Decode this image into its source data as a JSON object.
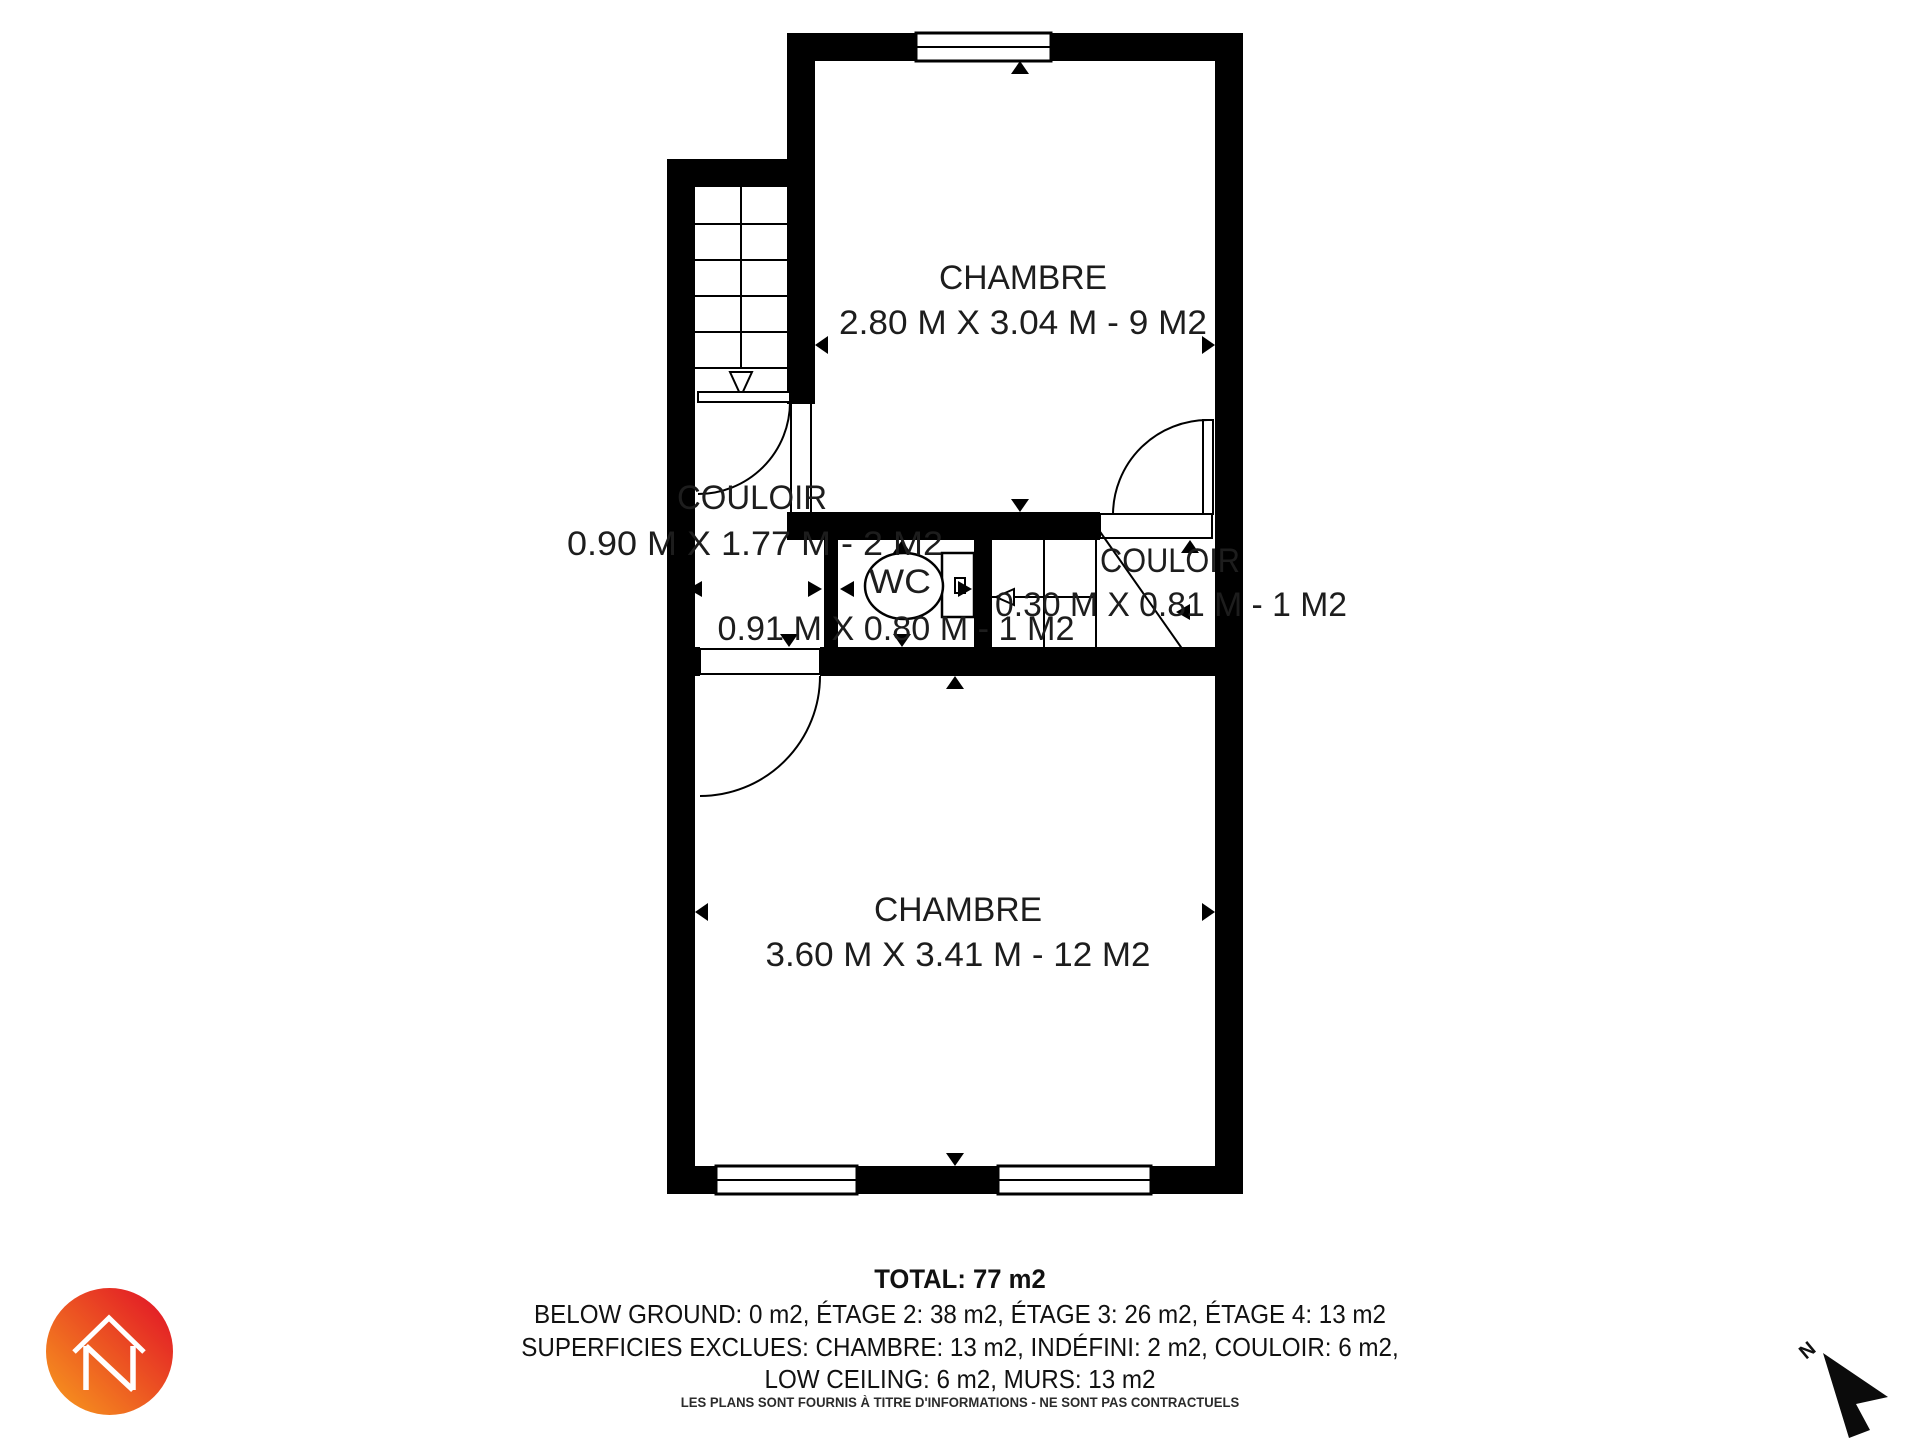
{
  "page": {
    "background": "#ffffff",
    "wall_color": "#000000",
    "text_color": "#1d1d1d"
  },
  "plan": {
    "rooms": {
      "chambre_top": {
        "name": "CHAMBRE",
        "dims": "2.80 M X 3.04 M - 9 M2"
      },
      "couloir_left": {
        "name": "COULOIR",
        "dims": "0.90 M X 1.77 M - 2 M2"
      },
      "wc": {
        "name": "WC",
        "dims": "0.91 M X 0.80 M - 1 M2"
      },
      "couloir_right": {
        "name": "COULOIR",
        "dims": "0.30 M X 0.81 M - 1 M2"
      },
      "chambre_bottom": {
        "name": "CHAMBRE",
        "dims": "3.60 M X 3.41 M - 12 M2"
      }
    }
  },
  "summary": {
    "total": "TOTAL: 77 m2",
    "floors": "BELOW GROUND: 0 m2, ÉTAGE 2: 38 m2, ÉTAGE 3: 26 m2, ÉTAGE 4: 13 m2",
    "excluded": "SUPERFICIES EXCLUES: CHAMBRE: 13 m2, INDÉFINI: 2 m2, COULOIR: 6 m2,",
    "excluded2": "LOW CEILING: 6 m2, MURS: 13 m2"
  },
  "disclaimer": "LES PLANS SONT FOURNIS À TITRE D'INFORMATIONS - NE SONT PAS CONTRACTUELS",
  "compass": {
    "label": "N"
  },
  "logo": {
    "colors": {
      "start": "#F6921E",
      "end": "#E31E26"
    }
  }
}
